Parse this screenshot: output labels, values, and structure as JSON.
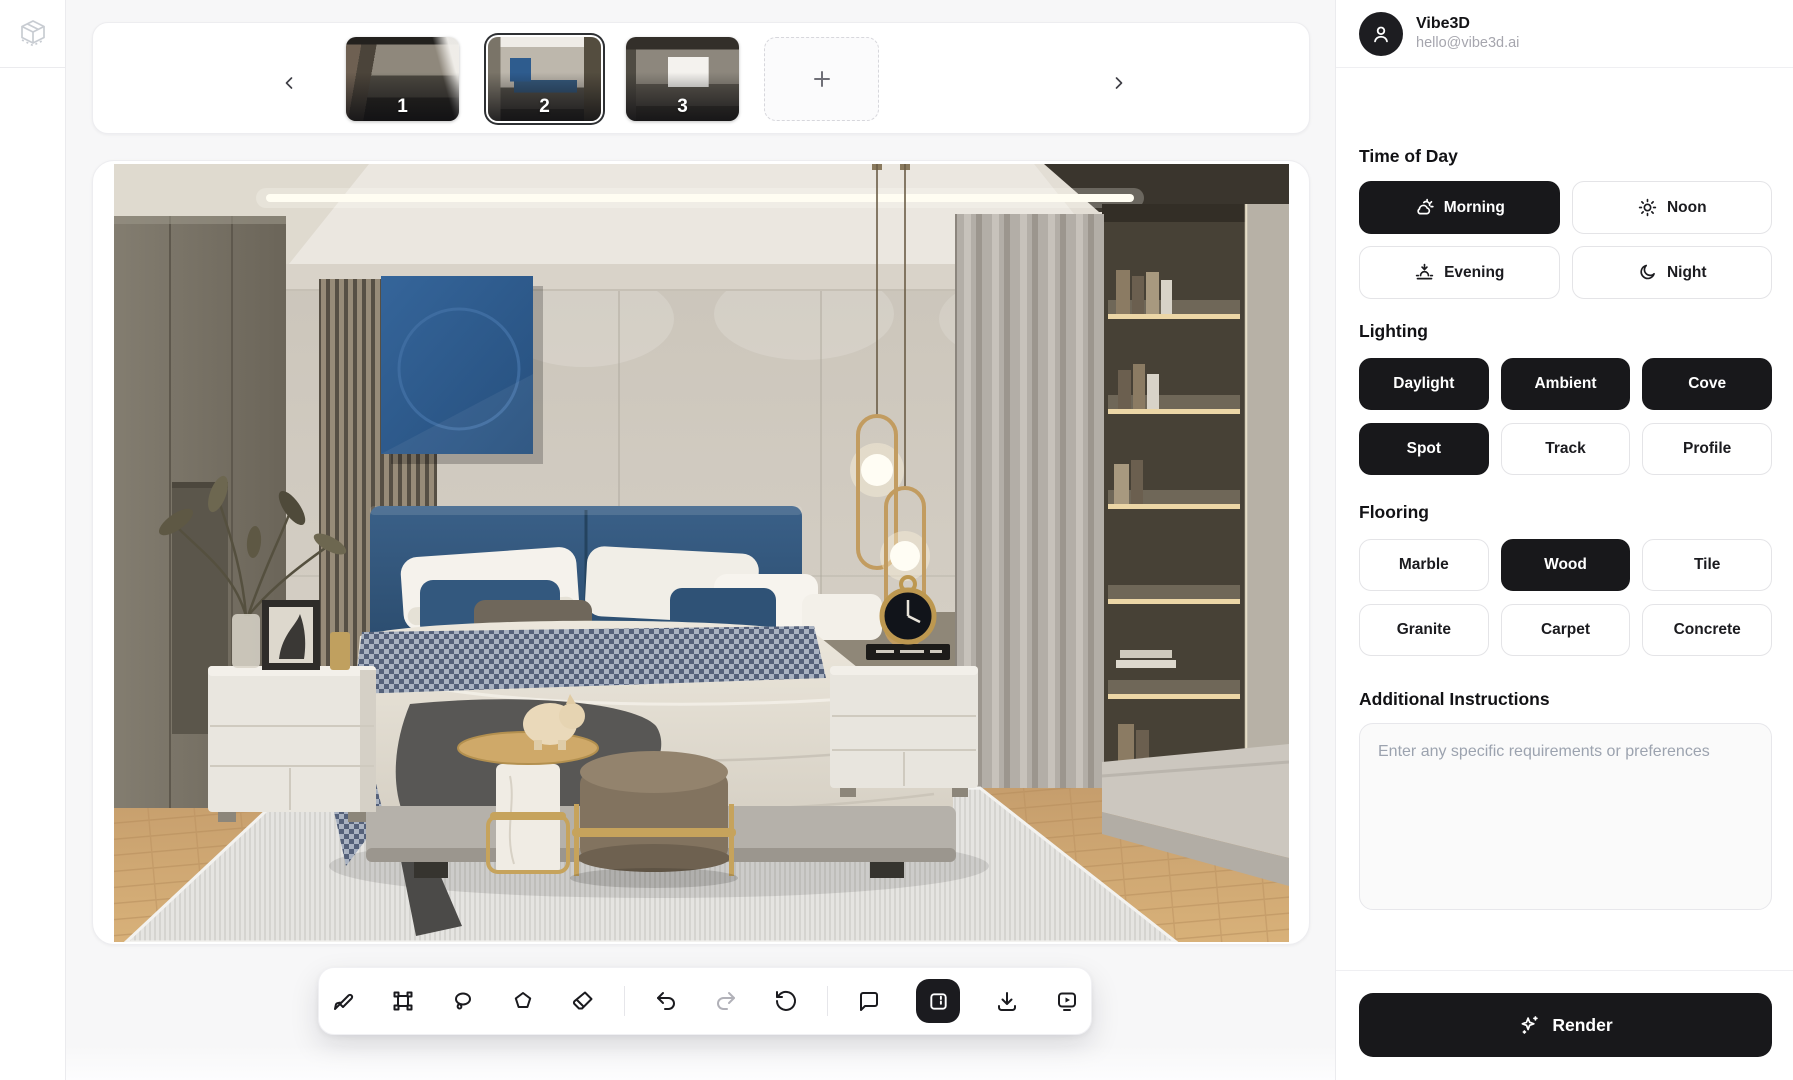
{
  "user": {
    "name": "Vibe3D",
    "email": "hello@vibe3d.ai"
  },
  "carousel": {
    "thumbnails": [
      {
        "label": "1",
        "selected": false
      },
      {
        "label": "2",
        "selected": true
      },
      {
        "label": "3",
        "selected": false
      }
    ],
    "prev_icon": "chevron-left-icon",
    "next_icon": "chevron-right-icon",
    "add_icon": "plus-icon"
  },
  "toolbar": {
    "tools": [
      "paintbrush",
      "transform-select",
      "lasso",
      "polygon",
      "eraser",
      "undo",
      "redo",
      "reset-rotate",
      "comment",
      "split-compare",
      "download",
      "screen-play"
    ],
    "active_tool": "split-compare",
    "disabled_tool": "redo"
  },
  "panel": {
    "time_of_day": {
      "heading": "Time of Day",
      "options": [
        {
          "label": "Morning",
          "icon": "cloud-sun-icon",
          "selected": true
        },
        {
          "label": "Noon",
          "icon": "sun-icon",
          "selected": false
        },
        {
          "label": "Evening",
          "icon": "sunset-icon",
          "selected": false
        },
        {
          "label": "Night",
          "icon": "moon-icon",
          "selected": false
        }
      ]
    },
    "lighting": {
      "heading": "Lighting",
      "options": [
        {
          "label": "Daylight",
          "selected": true
        },
        {
          "label": "Ambient",
          "selected": true
        },
        {
          "label": "Cove",
          "selected": true
        },
        {
          "label": "Spot",
          "selected": true
        },
        {
          "label": "Track",
          "selected": false
        },
        {
          "label": "Profile",
          "selected": false
        }
      ]
    },
    "flooring": {
      "heading": "Flooring",
      "options": [
        {
          "label": "Marble",
          "selected": false
        },
        {
          "label": "Wood",
          "selected": true
        },
        {
          "label": "Tile",
          "selected": false
        },
        {
          "label": "Granite",
          "selected": false
        },
        {
          "label": "Carpet",
          "selected": false
        },
        {
          "label": "Concrete",
          "selected": false
        }
      ]
    },
    "instructions": {
      "heading": "Additional Instructions",
      "placeholder": "Enter any specific requirements or preferences"
    },
    "render": {
      "label": "Render",
      "icon": "sparkles-icon"
    }
  },
  "colors": {
    "accent": "#18181b",
    "panel_bg": "#ffffff",
    "page_bg": "#f7f7f8",
    "border": "#e4e4e7",
    "muted_text": "#a1a1aa",
    "painting_blue": "#2e5c8e"
  }
}
